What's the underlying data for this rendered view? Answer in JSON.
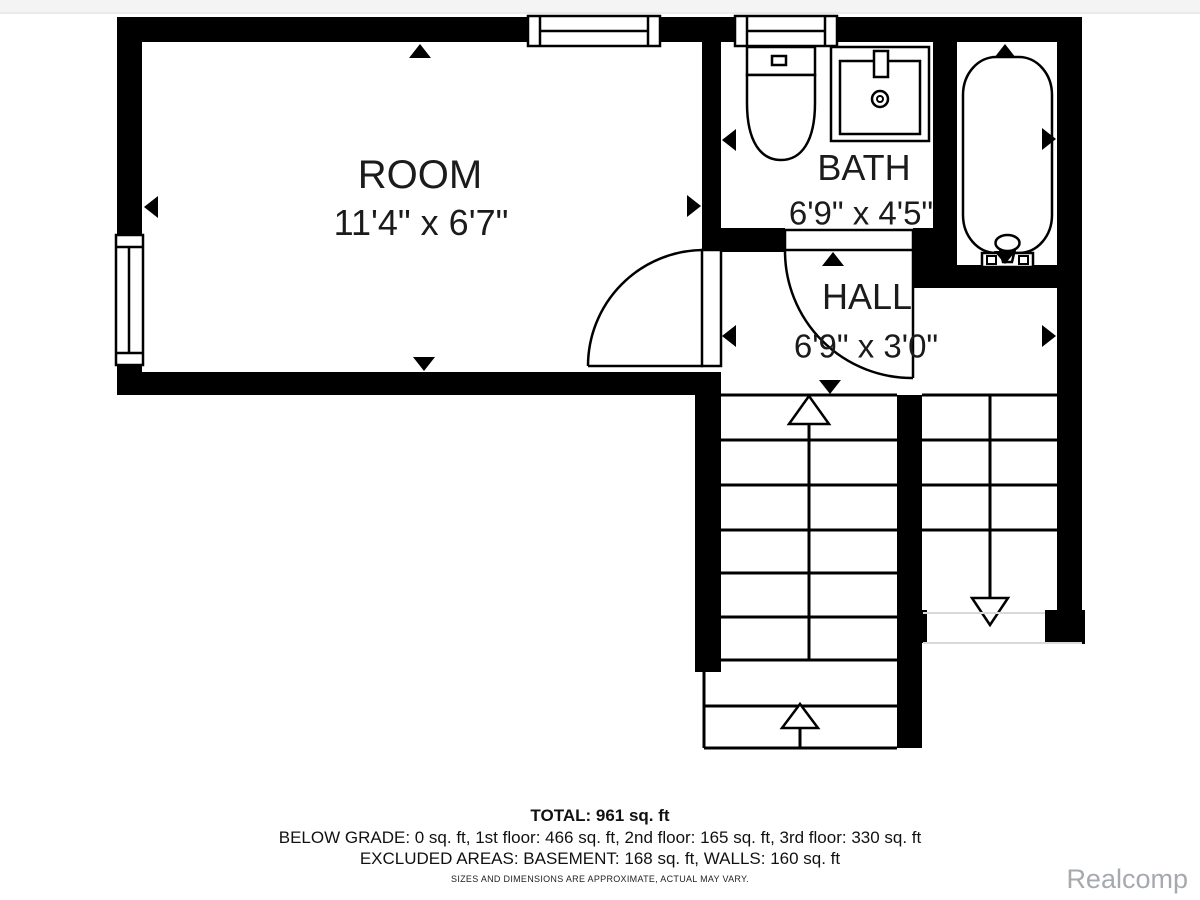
{
  "colors": {
    "wall": "#000000",
    "background": "#ffffff",
    "faint": "#d9d9d9",
    "watermark": "#a6a9ae"
  },
  "rooms": {
    "room": {
      "label": "ROOM",
      "dims": "11'4\" x 6'7\""
    },
    "bath": {
      "label": "BATH",
      "dims": "6'9\" x 4'5\""
    },
    "hall": {
      "label": "HALL",
      "dims": "6'9\" x 3'0\""
    }
  },
  "footer": {
    "total": "TOTAL: 961 sq. ft",
    "floors": "BELOW GRADE: 0 sq. ft, 1st floor: 466 sq. ft, 2nd floor: 165 sq. ft, 3rd floor: 330 sq. ft",
    "excluded": "EXCLUDED AREAS: BASEMENT: 168 sq. ft, WALLS: 160 sq. ft",
    "disclaimer": "SIZES AND DIMENSIONS ARE APPROXIMATE, ACTUAL MAY VARY."
  },
  "watermark": "Realcomp"
}
